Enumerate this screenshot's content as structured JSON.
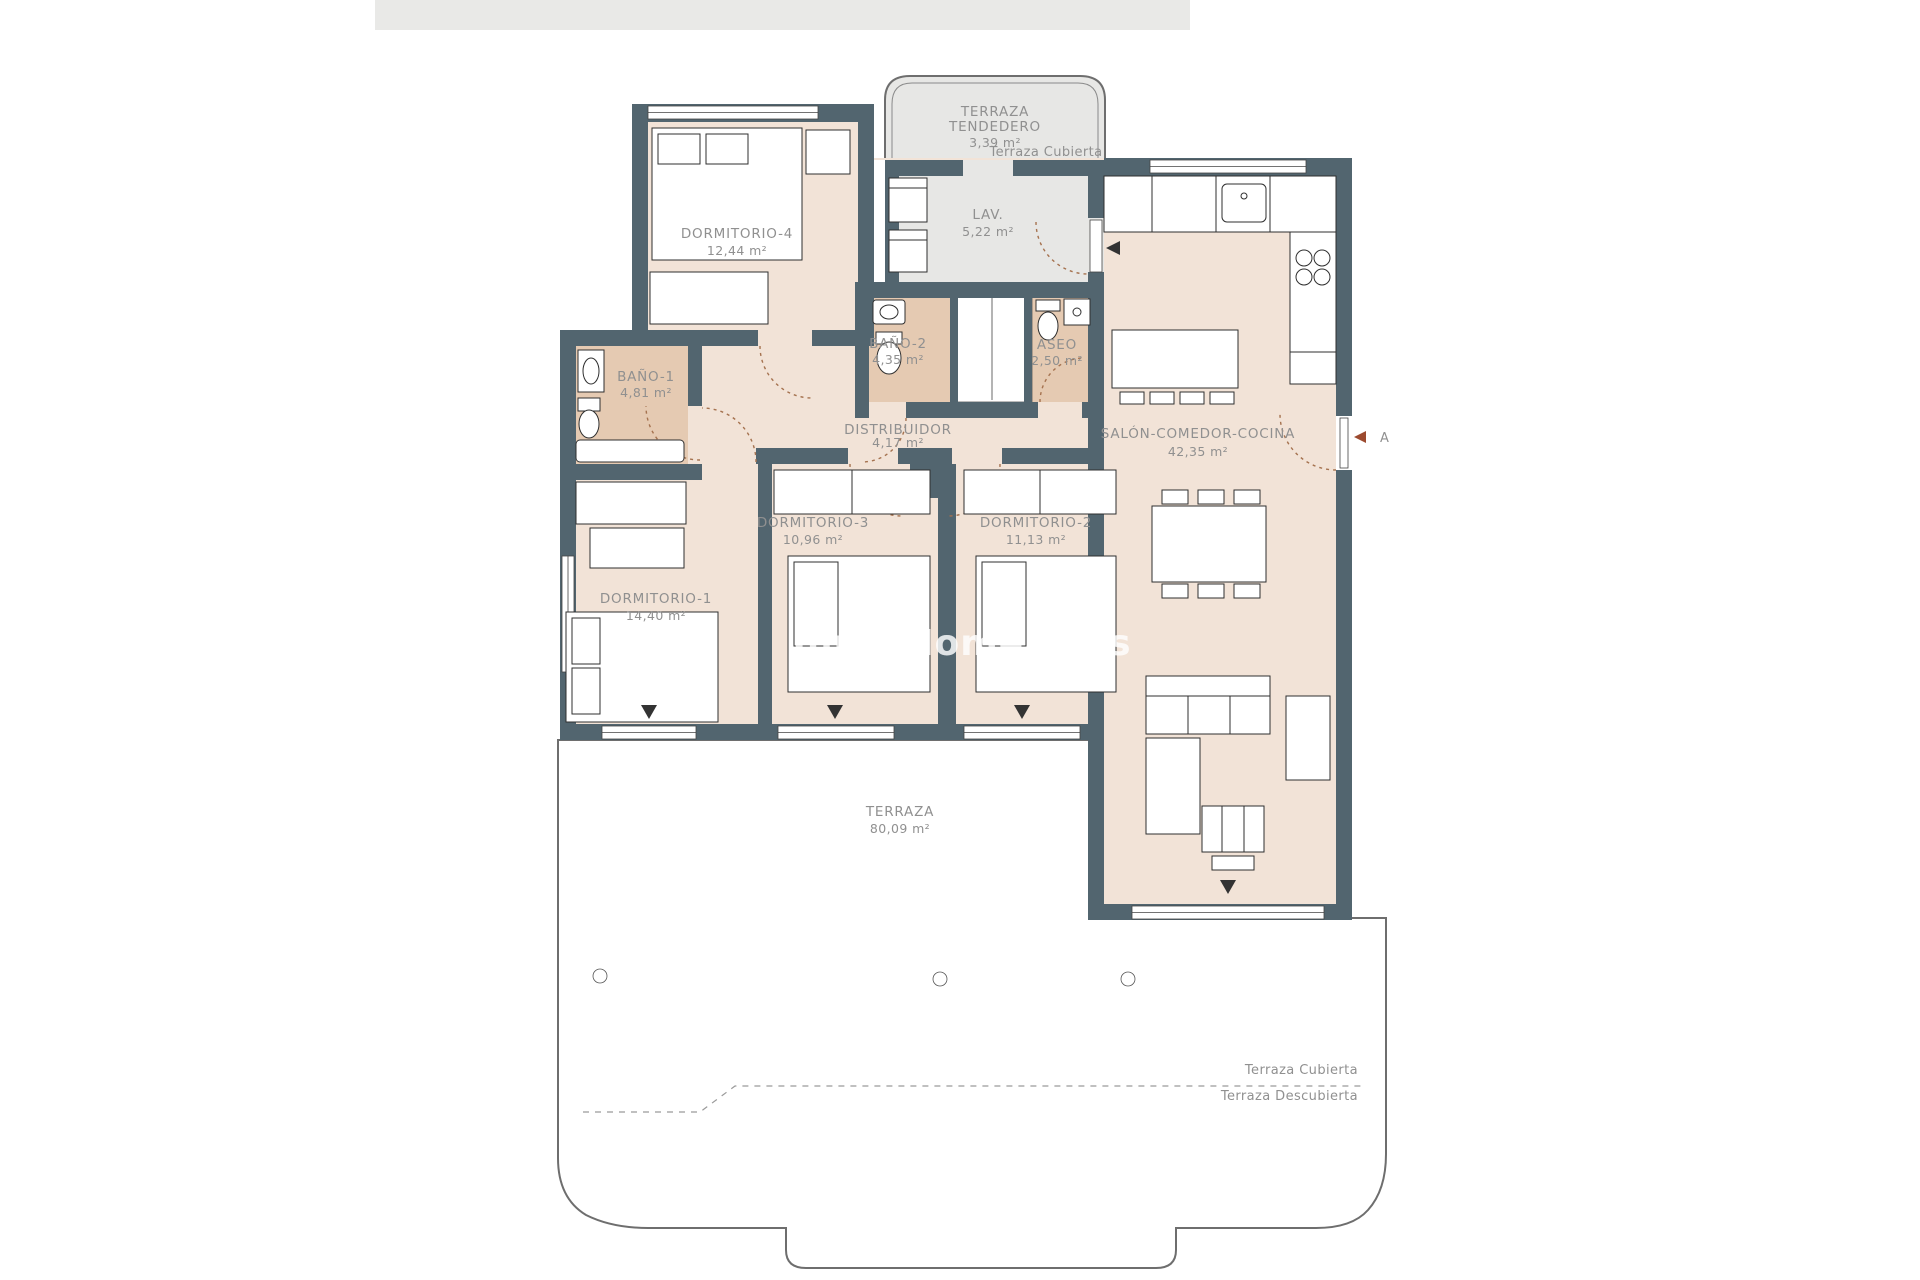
{
  "colors": {
    "wall": "#52656f",
    "room_floor": "#f2e3d7",
    "bath_floor": "#e5cab2",
    "grey_floor": "#e7e7e5",
    "top_bar": "#e9e9e7",
    "label": "#909090",
    "door_arc": "#a5724f",
    "accent_marker": "#9c4a2f"
  },
  "watermark": {
    "text": "InmoMoment.es"
  },
  "rooms": {
    "tendedero": {
      "name1": "TERRAZA",
      "name2": "TENDEDERO",
      "area": "3,39 m²"
    },
    "lav": {
      "name": "LAV.",
      "area": "5,22 m²"
    },
    "dormitorio4": {
      "name": "DORMITORIO-4",
      "area": "12,44 m²"
    },
    "bano1": {
      "name": "BAÑO-1",
      "area": "4,81 m²"
    },
    "bano2": {
      "name": "BAÑO-2",
      "area": "4,35 m²"
    },
    "aseo": {
      "name": "ASEO",
      "area": "2,50 m²"
    },
    "distribuidor": {
      "name": "DISTRIBUIDOR",
      "area": "4,17 m²"
    },
    "salon": {
      "name": "SALÓN-COMEDOR-COCINA",
      "area": "42,35 m²"
    },
    "dormitorio3": {
      "name": "DORMITORIO-3",
      "area": "10,96 m²"
    },
    "dormitorio2": {
      "name": "DORMITORIO-2",
      "area": "11,13 m²"
    },
    "dormitorio1": {
      "name": "DORMITORIO-1",
      "area": "14,40 m²"
    },
    "terraza": {
      "name": "TERRAZA",
      "area": "80,09 m²"
    }
  },
  "annotations": {
    "terraza_cubierta_top": "Terraza Cubierta",
    "terraza_cubierta_bottom": "Terraza Cubierta",
    "terraza_descubierta": "Terraza Descubierta",
    "section_letter": "A"
  }
}
